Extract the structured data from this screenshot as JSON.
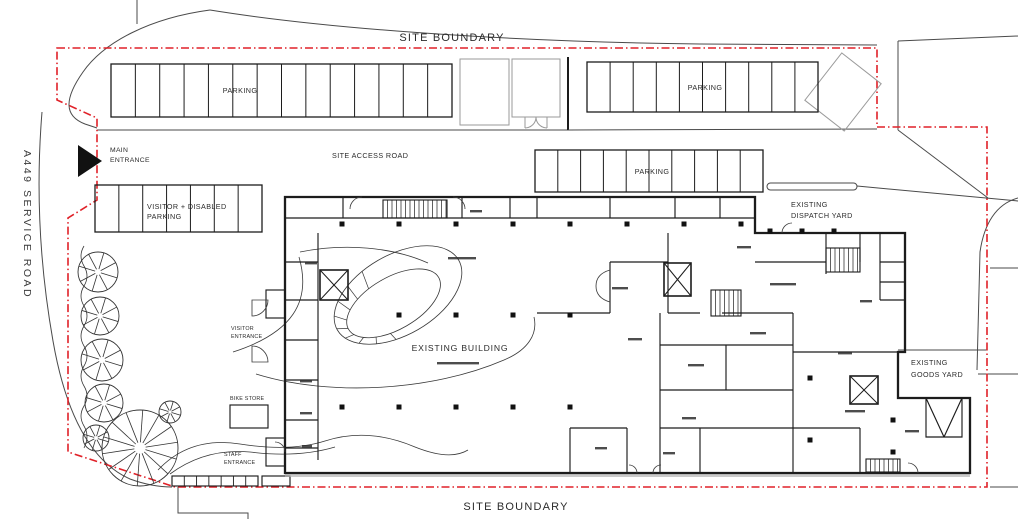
{
  "drawing": {
    "site_boundary_top": "SITE BOUNDARY",
    "site_boundary_bottom": "SITE BOUNDARY",
    "service_road_label": "A449 SERVICE ROAD",
    "site_access_road_label": "SITE ACCESS ROAD",
    "main_entrance": {
      "line1": "MAIN",
      "line2": "ENTRANCE"
    },
    "visitor_entrance": {
      "line1": "VISITOR",
      "line2": "ENTRANCE"
    },
    "staff_entrance": {
      "line1": "STAFF",
      "line2": "ENTRANCE"
    },
    "bike_store_label": "BIKE STORE",
    "existing_building_label": "EXISTING BUILDING",
    "dispatch_yard": {
      "line1": "EXISTING",
      "line2": "DISPATCH YARD"
    },
    "goods_yard": {
      "line1": "EXISTING",
      "line2": "GOODS YARD"
    }
  },
  "parking_lots": [
    {
      "name": "north-west-row",
      "label": "PARKING",
      "stalls": 14
    },
    {
      "name": "north-east-row",
      "label": "PARKING",
      "stalls": 10
    },
    {
      "name": "central-row",
      "label": "PARKING",
      "stalls": 10
    },
    {
      "name": "visitor-disabled-row",
      "label_line1": "VISITOR + DISABLED",
      "label_line2": "PARKING",
      "stalls": 7
    }
  ],
  "colors": {
    "site_boundary": "#e02128",
    "drawing_lines": "#1c1c1c",
    "secondary_lines": "#9a9a9a"
  }
}
